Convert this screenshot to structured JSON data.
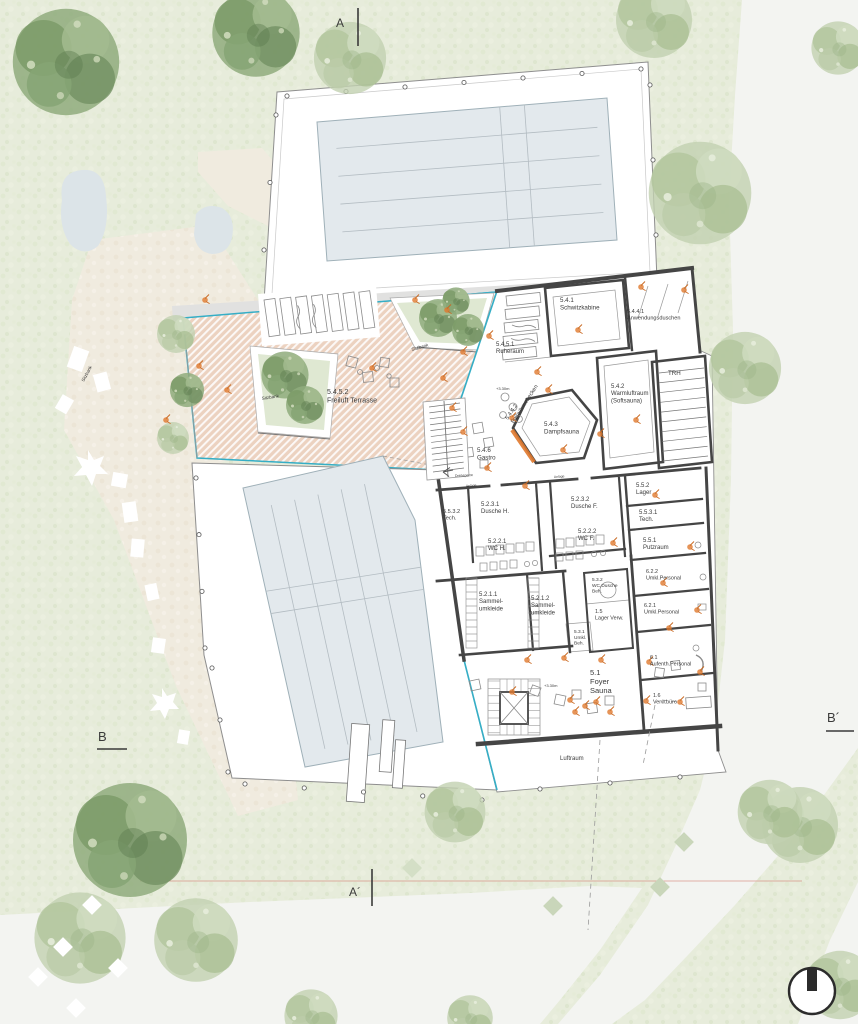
{
  "plan": {
    "title": "Pool and sauna level floor plan (site plan)",
    "north_indicator": "north-arrow",
    "colors": {
      "glass_accent": "#35aec6",
      "terrace_hatch": "#ecd2c0",
      "orange_marker": "#e0792e",
      "pool_fill": "#e3e9ed",
      "wall": "#454545",
      "section_line_red": "#d3776e",
      "ground_green": "#e7ecdb",
      "path_beige": "#f0ebdf",
      "road_gray": "#f3f4f1"
    },
    "section_markers": {
      "a": "A",
      "a_prime": "A´",
      "b": "B",
      "b_prime": "B´"
    },
    "labels": [
      {
        "id": "section-a",
        "text": "A",
        "x": 336,
        "y": 27,
        "s": 12
      },
      {
        "id": "section-a-prime",
        "text": "A´",
        "x": 349,
        "y": 896,
        "s": 12
      },
      {
        "id": "section-b",
        "text": "B",
        "x": 98,
        "y": 741,
        "s": 13
      },
      {
        "id": "section-b-prime",
        "text": "B´",
        "x": 827,
        "y": 722,
        "s": 13
      },
      {
        "id": "label-freiluft-terrasse",
        "text": "5.4.5.2\nFreiluft Terrasse",
        "x": 327,
        "y": 394,
        "s": 7
      },
      {
        "id": "label-sitzbank-1",
        "text": "Sitzbank",
        "x": 84,
        "y": 382,
        "s": 4.5,
        "r": -62,
        "c": "#555555"
      },
      {
        "id": "label-sitzbank-2",
        "text": "Sitzbank",
        "x": 262,
        "y": 400,
        "s": 4.5,
        "r": -9,
        "c": "#555555"
      },
      {
        "id": "label-sitzbank-3",
        "text": "Sitzbank",
        "x": 412,
        "y": 351,
        "s": 4.5,
        "r": -16,
        "c": "#555555"
      },
      {
        "id": "label-ruheraum",
        "text": "5.4.5.1\nRuheraum",
        "x": 496,
        "y": 346,
        "s": 6
      },
      {
        "id": "label-schwitzkabine",
        "text": "5.4.1\nSchwitzkabine",
        "x": 560,
        "y": 302,
        "s": 6.2
      },
      {
        "id": "label-anwendungsduschen",
        "text": "5.4.4.1\nAnwendungsduschen",
        "x": 627,
        "y": 313,
        "s": 5.6
      },
      {
        "id": "label-trh",
        "text": "TRH",
        "x": 668,
        "y": 375,
        "s": 6.2
      },
      {
        "id": "label-warmluftraum",
        "text": "5.4.2\nWarmluftraum\n(Softsauna)",
        "x": 611,
        "y": 388,
        "s": 6
      },
      {
        "id": "label-dampfsauna",
        "text": "5.4.3\nDampfsauna",
        "x": 544,
        "y": 426,
        "s": 6.2
      },
      {
        "id": "label-fusswaermebecken",
        "text": "5.4.4.2\nFußwärmebecken",
        "x": 508,
        "y": 420,
        "s": 5.6,
        "r": -57
      },
      {
        "id": "label-gastro",
        "text": "5.4.6\nGastro",
        "x": 477,
        "y": 452,
        "s": 6.2
      },
      {
        "id": "label-level-1",
        "text": "+3.30m",
        "x": 496,
        "y": 390,
        "s": 4,
        "c": "#8a8a8a"
      },
      {
        "id": "label-level-2",
        "text": "+3.30m",
        "x": 544,
        "y": 687,
        "s": 4,
        "c": "#8a8a8a"
      },
      {
        "id": "label-anlage-1",
        "text": "Anlage",
        "x": 466,
        "y": 487,
        "s": 3.4,
        "r": -4,
        "c": "#666666"
      },
      {
        "id": "label-anlage-2",
        "text": "Anlage",
        "x": 554,
        "y": 478,
        "s": 3.4,
        "r": -4,
        "c": "#666666"
      },
      {
        "id": "label-drehsperre",
        "text": "Drehsperre",
        "x": 455,
        "y": 477,
        "s": 3.6,
        "r": -3,
        "c": "#555555"
      },
      {
        "id": "label-tech-5532",
        "text": "5.5.3.2\nTech.",
        "x": 443,
        "y": 513,
        "s": 5.6
      },
      {
        "id": "label-dusche-h",
        "text": "5.2.3.1\nDusche H.",
        "x": 481,
        "y": 506,
        "s": 6
      },
      {
        "id": "label-wc-h",
        "text": "5.2.2.1\nWC H.",
        "x": 488,
        "y": 543,
        "s": 6
      },
      {
        "id": "label-dusche-f",
        "text": "5.2.3.2\nDusche F.",
        "x": 571,
        "y": 501,
        "s": 6
      },
      {
        "id": "label-wc-f",
        "text": "5.2.2.2\nWC F.",
        "x": 578,
        "y": 533,
        "s": 6
      },
      {
        "id": "label-lager-552",
        "text": "5.5.2\nLager",
        "x": 636,
        "y": 487,
        "s": 6
      },
      {
        "id": "label-tech-5531",
        "text": "5.5.3.1\nTech.",
        "x": 639,
        "y": 514,
        "s": 6
      },
      {
        "id": "label-putzraum",
        "text": "5.5.1\nPutzraum",
        "x": 643,
        "y": 542,
        "s": 6
      },
      {
        "id": "label-umkl-622",
        "text": "6.2.2\nUmkl.Personal",
        "x": 646,
        "y": 573,
        "s": 5.4
      },
      {
        "id": "label-sammel-1",
        "text": "5.2.1.1\nSammel-\numkleide",
        "x": 479,
        "y": 596,
        "s": 6
      },
      {
        "id": "label-sammel-2",
        "text": "5.2.1.2\nSammel-\numkleide",
        "x": 531,
        "y": 600,
        "s": 6
      },
      {
        "id": "label-wc-beh",
        "text": "5.3.2\nWC,Dusche\nBeh.",
        "x": 592,
        "y": 581,
        "s": 4.8
      },
      {
        "id": "label-lager-verw",
        "text": "1.5\nLager Verw.",
        "x": 595,
        "y": 613,
        "s": 5.4
      },
      {
        "id": "label-umkl-beh",
        "text": "5.3.1\nUmkl.\nBeh.",
        "x": 574,
        "y": 633,
        "s": 4.8
      },
      {
        "id": "label-umkl-621",
        "text": "6.2.1\nUmkl.Personal",
        "x": 644,
        "y": 607,
        "s": 5.4
      },
      {
        "id": "label-aufenth",
        "text": "6.1\nAufenth.Personal",
        "x": 650,
        "y": 659,
        "s": 5.4
      },
      {
        "id": "label-verwbuero",
        "text": "1.6\nVerw.büro",
        "x": 653,
        "y": 697,
        "s": 5.4
      },
      {
        "id": "label-foyer",
        "text": "5.1\nFoyer\nSauna",
        "x": 590,
        "y": 675,
        "s": 7.5
      },
      {
        "id": "label-luftraum",
        "text": "Luftraum",
        "x": 560,
        "y": 760,
        "s": 6
      }
    ]
  }
}
